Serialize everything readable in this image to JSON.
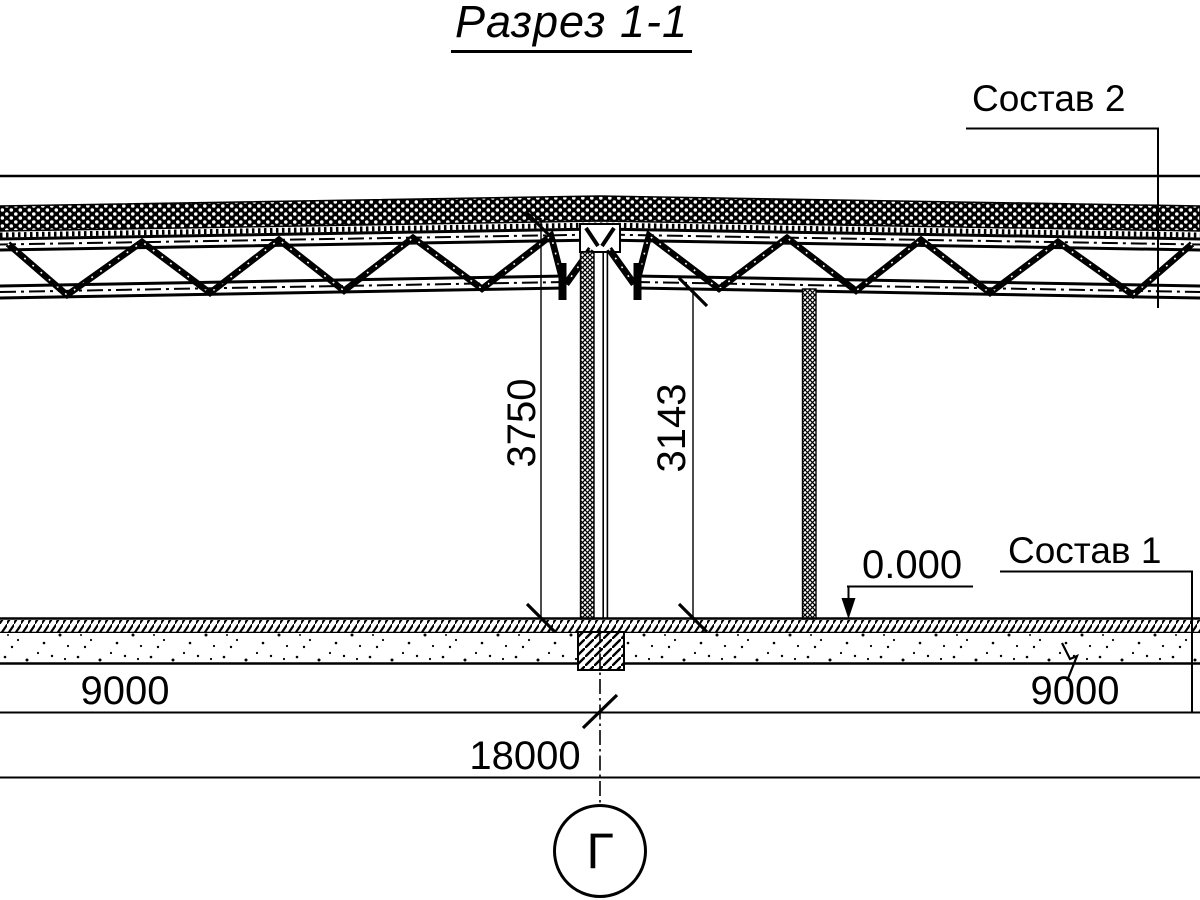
{
  "page": {
    "background_color": "#ffffff",
    "line_color": "#000000"
  },
  "title": {
    "text": "Разрез 1-1"
  },
  "callouts": {
    "roof_composition": "Состав 2",
    "floor_composition": "Состав 1",
    "elevation_mark": "0.000"
  },
  "dimensions": {
    "height_total": "3750",
    "height_clear": "3143",
    "bay_left": "9000",
    "bay_right": "9000",
    "span_total": "18000"
  },
  "axis": {
    "label": "Г"
  }
}
